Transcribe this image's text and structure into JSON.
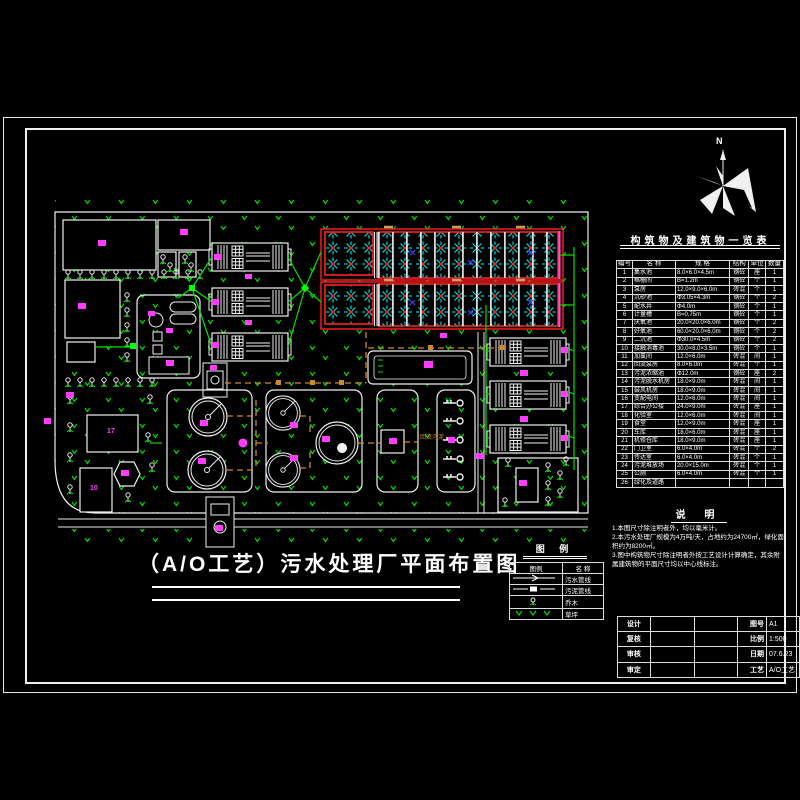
{
  "title": {
    "text": "（A/O工艺）污水处理厂平面布置图"
  },
  "north": {
    "label": "N"
  },
  "plan": {
    "building_17": "17",
    "building_10": "10",
    "sludge_pipe_label": "回流污泥"
  },
  "structures": {
    "title": "构筑物及建筑物一览表",
    "headers": [
      "编号",
      "名 称",
      "规 格",
      "结构",
      "单位",
      "数量"
    ],
    "rows": [
      {
        "no": "1",
        "name": "集水池",
        "spec": "8.0×6.0×4.5m",
        "struct": "钢砼",
        "unit": "座",
        "qty": "1"
      },
      {
        "no": "2",
        "name": "格栅间",
        "spec": "B=1.2m",
        "struct": "钢砼",
        "unit": "个",
        "qty": "1"
      },
      {
        "no": "3",
        "name": "泵房",
        "spec": "12.0×9.0×6.0m",
        "struct": "砖混",
        "unit": "个",
        "qty": "1"
      },
      {
        "no": "4",
        "name": "沉砂池",
        "spec": "Φ3.05×4.3m",
        "struct": "钢砼",
        "unit": "个",
        "qty": "2"
      },
      {
        "no": "5",
        "name": "配水井",
        "spec": "Φ4.0m",
        "struct": "钢砼",
        "unit": "个",
        "qty": "1"
      },
      {
        "no": "6",
        "name": "计量槽",
        "spec": "B=0.75m",
        "struct": "钢砼",
        "unit": "个",
        "qty": "1"
      },
      {
        "no": "7",
        "name": "厌氧池",
        "spec": "20.0×20.0×6.0m",
        "struct": "钢砼",
        "unit": "个",
        "qty": "2"
      },
      {
        "no": "8",
        "name": "好氧池",
        "spec": "60.0×20.0×6.0m",
        "struct": "钢砼",
        "unit": "个",
        "qty": "2"
      },
      {
        "no": "9",
        "name": "二沉池",
        "spec": "Φ30.0×4.5m",
        "struct": "钢砼",
        "unit": "个",
        "qty": "2"
      },
      {
        "no": "10",
        "name": "接触消毒池",
        "spec": "30.0×8.0×3.5m",
        "struct": "钢砼",
        "unit": "个",
        "qty": "1"
      },
      {
        "no": "11",
        "name": "加氯间",
        "spec": "12.0×6.0m",
        "struct": "砖混",
        "unit": "间",
        "qty": "1"
      },
      {
        "no": "12",
        "name": "回流泵房",
        "spec": "8.0×6.0m",
        "struct": "砖混",
        "unit": "个",
        "qty": "1"
      },
      {
        "no": "13",
        "name": "污泥浓缩池",
        "spec": "Φ12.0m",
        "struct": "钢砼",
        "unit": "座",
        "qty": "2"
      },
      {
        "no": "14",
        "name": "污泥脱水机房",
        "spec": "18.0×9.0m",
        "struct": "砖混",
        "unit": "间",
        "qty": "1"
      },
      {
        "no": "15",
        "name": "鼓风机房",
        "spec": "18.0×9.0m",
        "struct": "砖混",
        "unit": "间",
        "qty": "1"
      },
      {
        "no": "16",
        "name": "变配电间",
        "spec": "12.0×6.0m",
        "struct": "砖混",
        "unit": "间",
        "qty": "1"
      },
      {
        "no": "17",
        "name": "综合办公楼",
        "spec": "24.0×9.0m",
        "struct": "砖混",
        "unit": "座",
        "qty": "1"
      },
      {
        "no": "18",
        "name": "化验室",
        "spec": "12.0×6.0m",
        "struct": "砖混",
        "unit": "间",
        "qty": "1"
      },
      {
        "no": "19",
        "name": "食堂",
        "spec": "12.0×9.0m",
        "struct": "砖混",
        "unit": "座",
        "qty": "1"
      },
      {
        "no": "20",
        "name": "车库",
        "spec": "18.0×6.0m",
        "struct": "砖混",
        "unit": "座",
        "qty": "1"
      },
      {
        "no": "21",
        "name": "机修仓库",
        "spec": "18.0×9.0m",
        "struct": "砖混",
        "unit": "座",
        "qty": "1"
      },
      {
        "no": "22",
        "name": "门卫室",
        "spec": "6.0×4.0m",
        "struct": "砖混",
        "unit": "个",
        "qty": "2"
      },
      {
        "no": "23",
        "name": "传达室",
        "spec": "6.0×4.0m",
        "struct": "砖混",
        "unit": "个",
        "qty": "1"
      },
      {
        "no": "24",
        "name": "污泥堆放场",
        "spec": "20.0×15.0m",
        "struct": "砖混",
        "unit": "个",
        "qty": "1"
      },
      {
        "no": "25",
        "name": "公厕",
        "spec": "6.0×4.0m",
        "struct": "砖混",
        "unit": "个",
        "qty": "1"
      },
      {
        "no": "26",
        "name": "绿化及道路",
        "spec": "",
        "struct": "",
        "unit": "",
        "qty": ""
      }
    ]
  },
  "notes": {
    "title": "说  明",
    "items": [
      "1.本图尺寸除注明者外，均以毫米计。",
      "2.本污水处理厂规模为4万吨/天，占地约为24700㎡，绿化面积约为8200㎡。",
      "3.图中构筑物尺寸除注明者外按工艺设计计算确定，其余附属建筑物的平面尺寸均以中心线标注。"
    ]
  },
  "legend": {
    "title": "图  例",
    "header": {
      "symbol": "图例",
      "name": "名 称"
    },
    "rows": [
      {
        "symbol": "sewer-line",
        "name": "污水管线"
      },
      {
        "symbol": "sludge-line",
        "name": "污泥管线"
      },
      {
        "symbol": "tree",
        "name": "乔木"
      },
      {
        "symbol": "lawn",
        "name": "草坪"
      }
    ]
  },
  "titleblock": {
    "design_label": "设计",
    "check_label": "复核",
    "review_label": "审核",
    "approve_label": "审定",
    "sheet_label": "图号",
    "sheet_no": "A1",
    "scale_label": "比例",
    "scale_value": "1:500",
    "date_label": "日期",
    "date_value": "07.6.23",
    "process_label": "工艺",
    "process_value": "A/O工艺"
  },
  "colors": {
    "line": "#ffffff",
    "vegetation": "#00dd00",
    "pipe_sewage": "#00e000",
    "pipe_sludge": "#cc8a2e",
    "basin_border": "#ff2020",
    "diffuser": "#00e8e8",
    "label": "#ff3cff"
  }
}
